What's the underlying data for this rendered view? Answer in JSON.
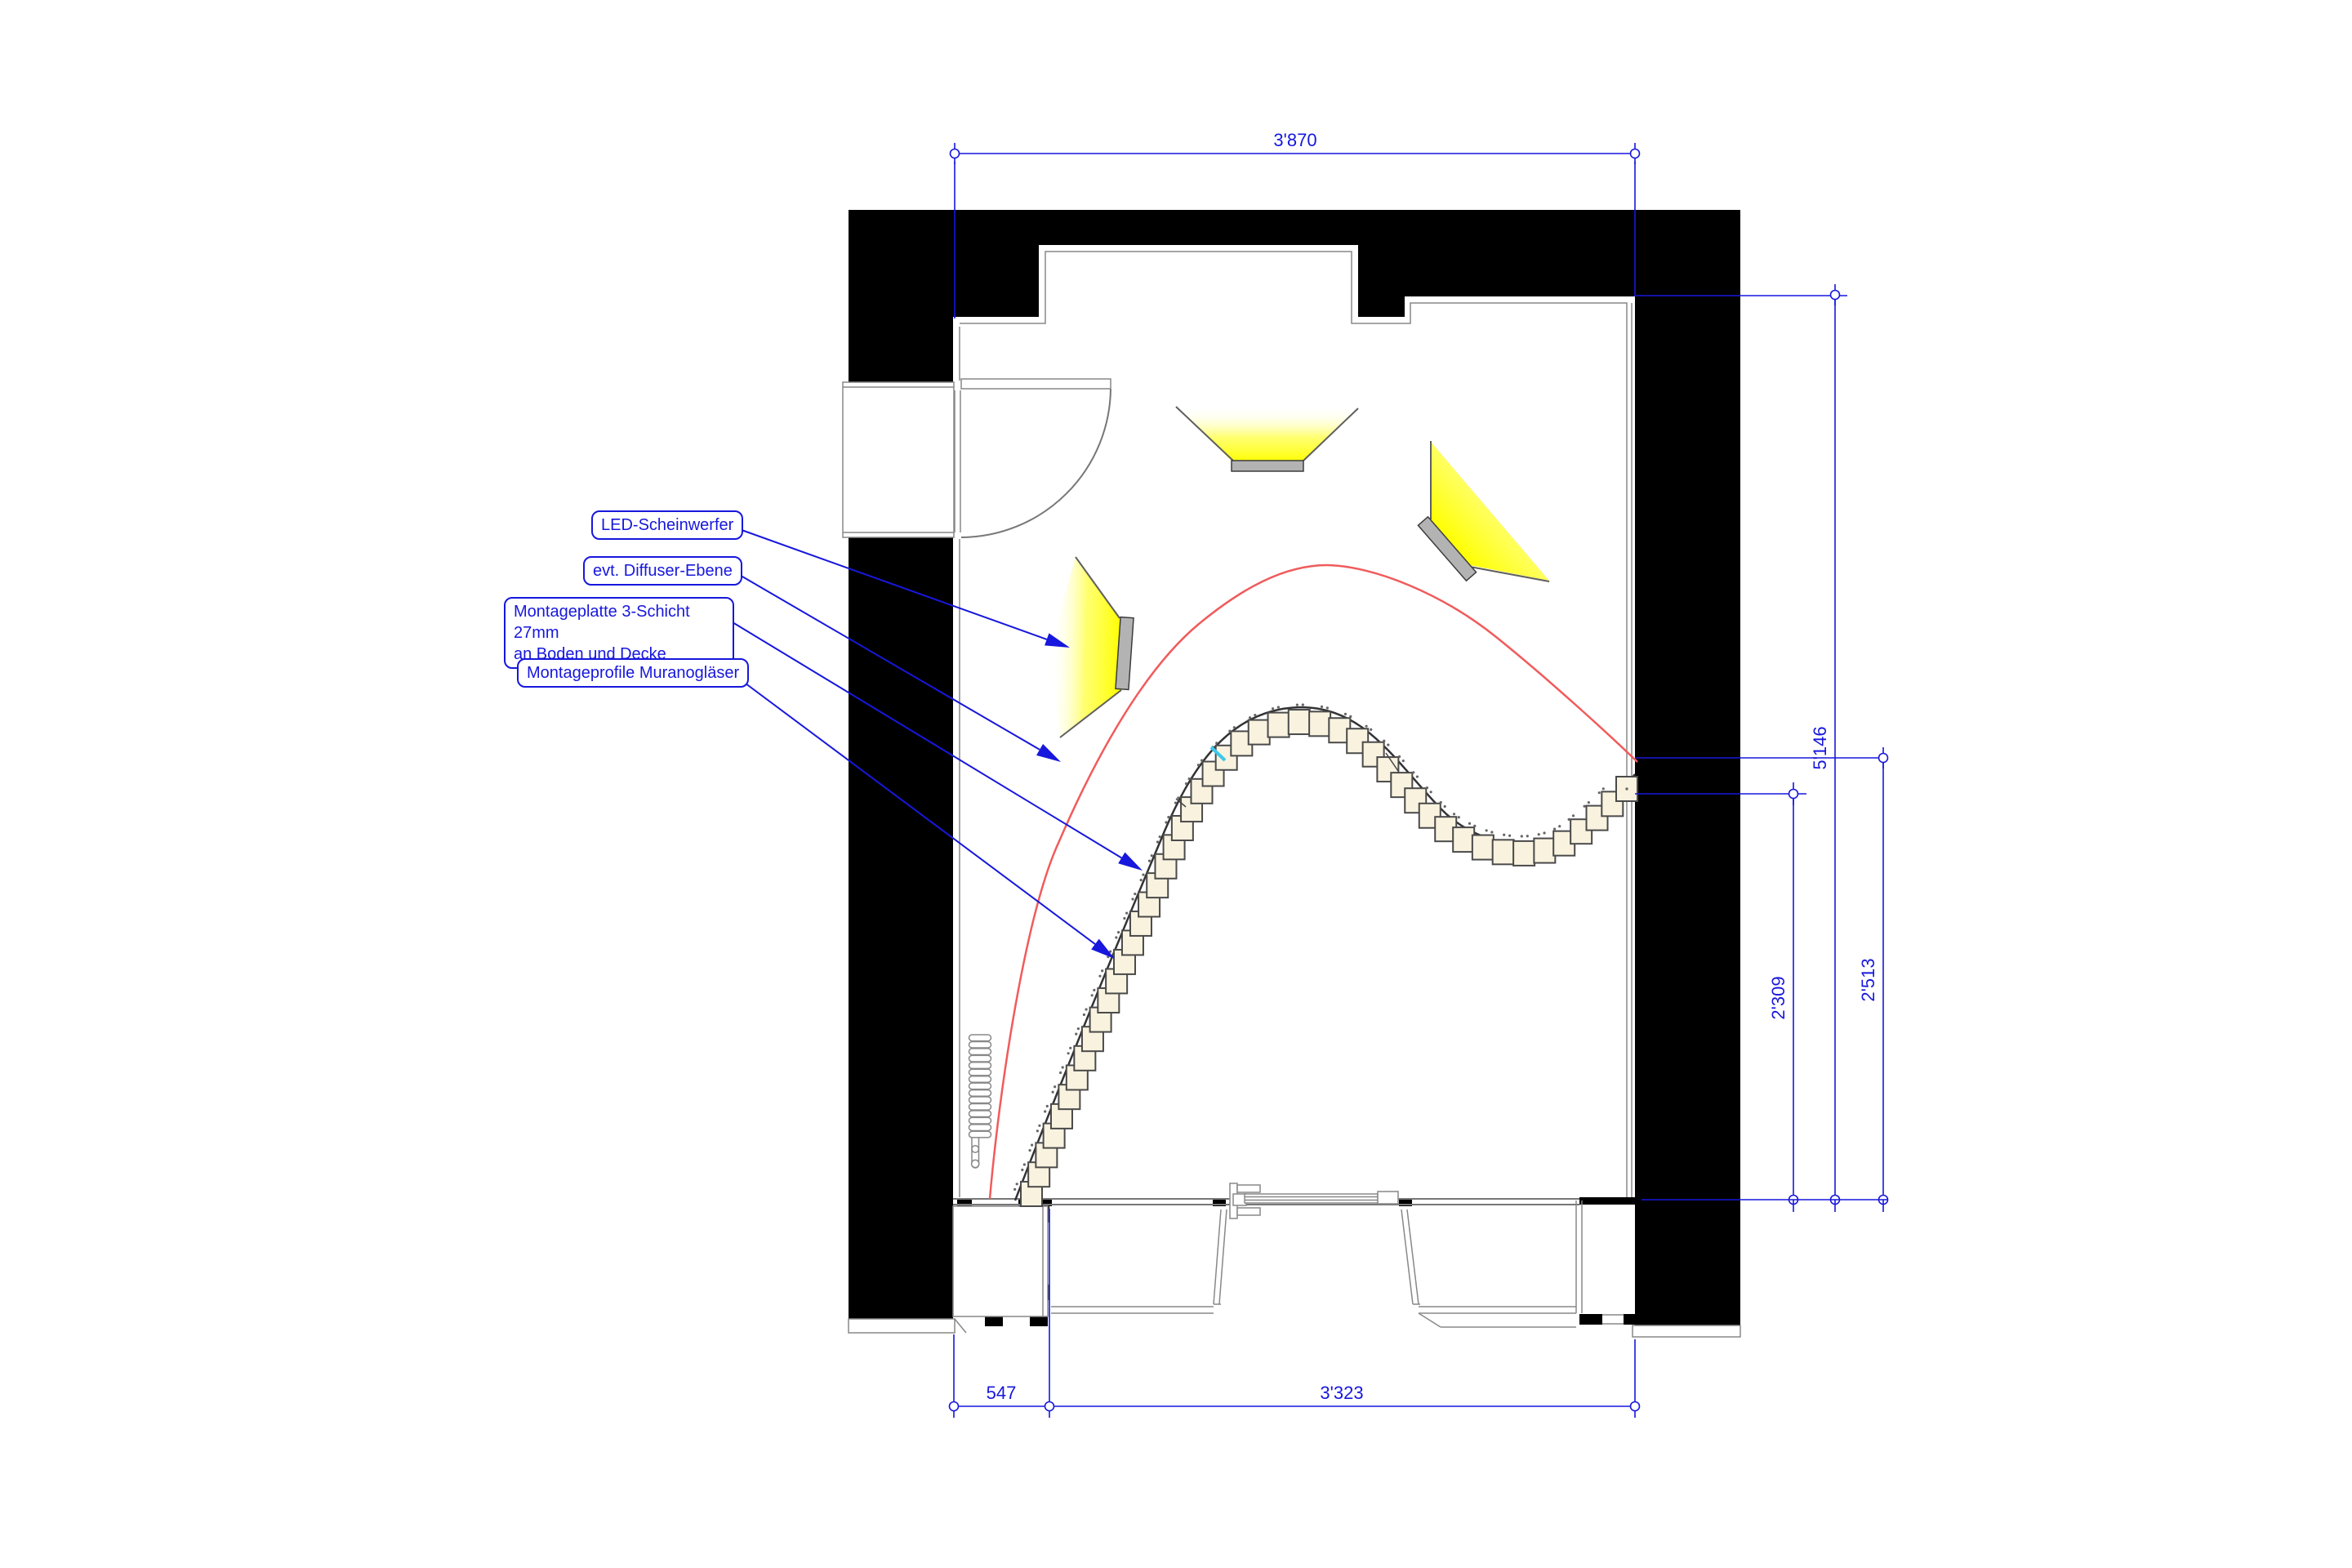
{
  "annotations": {
    "labels": [
      {
        "text": "LED-Scheinwerfer"
      },
      {
        "text": "evt. Diffuser-Ebene"
      },
      {
        "text": "Montageplatte 3-Schicht 27mm",
        "text2": "an Boden und Decke"
      },
      {
        "text": "Montageprofile Muranogläser"
      }
    ]
  },
  "dimensions": {
    "top": "3'870",
    "right_total": "5'146",
    "right_inner": "2'309",
    "right_outer": "2'513",
    "bottom_left": "547",
    "bottom_main": "3'323"
  },
  "colors": {
    "dimension_blue": "#1717dd",
    "wall_black": "#000000",
    "light_yellow": "#ffff00",
    "fixture_gray": "#b3b3b3",
    "glass_cream": "#f8f2df",
    "curve_red": "#f15b5b",
    "detail_cyan": "#3cc8ea"
  },
  "elements": {
    "murano_chain": {
      "count": 47,
      "square_w": 26,
      "square_h": 30
    },
    "radiator": {
      "fins": 15
    },
    "spotlights": {
      "count": 3
    }
  }
}
